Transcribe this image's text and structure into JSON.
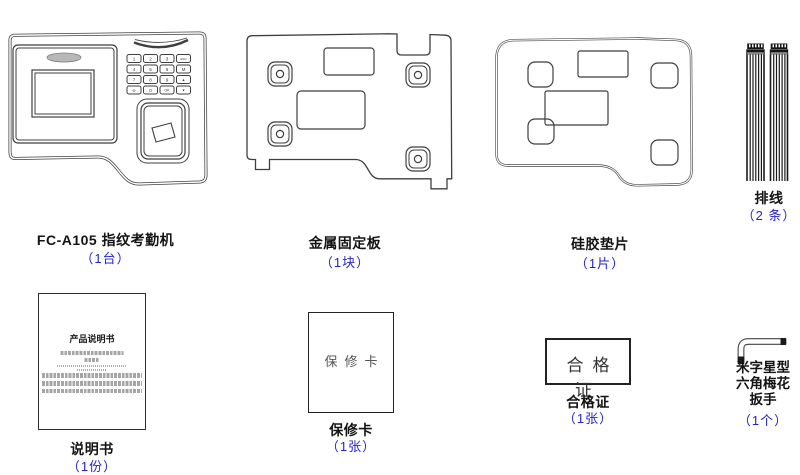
{
  "colors": {
    "accent_blue": "#2424cd",
    "line": "#3f3f3f"
  },
  "items": {
    "device": {
      "name": "FC-A105 指纹考勤机",
      "qty": "（1台）"
    },
    "plate": {
      "name": "金属固定板",
      "qty": "（1块）"
    },
    "pad": {
      "name": "硅胶垫片",
      "qty": "（1片）"
    },
    "cables": {
      "name": "排线",
      "qty": "（2 条）"
    },
    "manual": {
      "name": "说明书",
      "qty": "（1份）",
      "page_title": "产品说明书"
    },
    "warranty": {
      "name": "保修卡",
      "qty": "（1张）",
      "card_text": "保修卡"
    },
    "certificate": {
      "name": "合格证",
      "qty": "（1张）",
      "card_text": "合格证"
    },
    "wrench": {
      "name_lines": [
        "米字星型",
        "六角梅花",
        "扳手"
      ],
      "qty": "（1个）"
    }
  },
  "device_keys": [
    "1",
    "2",
    "3",
    "ESC",
    "4",
    "5",
    "6",
    "M",
    "7",
    "8",
    "9",
    "▲",
    "Φ",
    "0",
    "OK",
    "▼"
  ]
}
